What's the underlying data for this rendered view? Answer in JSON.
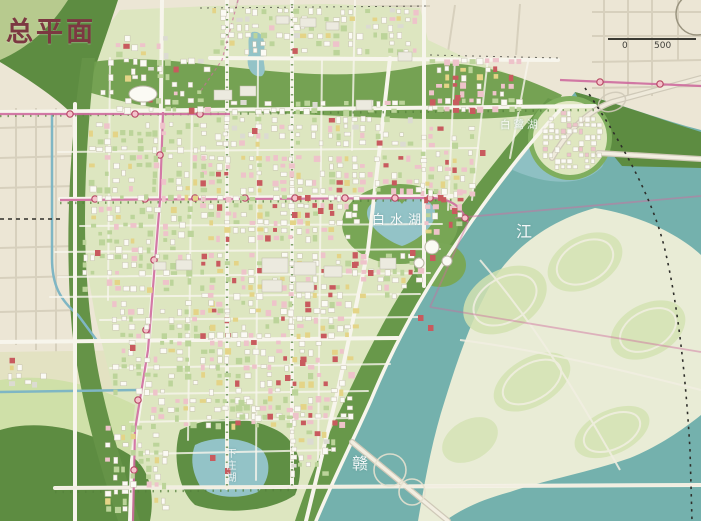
{
  "map": {
    "title": "总平面",
    "labels": {
      "lake_main": "白水湖",
      "lake_upper": "白鹭湖",
      "lake_lower": "下庄湖",
      "river_char_bottom": "赣",
      "river_char_top": "江"
    },
    "scale": {
      "zero": "0",
      "five_hundred": "500"
    },
    "palette": {
      "base": "#ece6d5",
      "baseRoad": "#d5cebb",
      "river": "#74b1ad",
      "innerLake": "#93c3c7",
      "island": "#e9ecd6",
      "islandGreen": "#d2e2b0",
      "cityBase": "#dde6c0",
      "parkGreen": "#6f9e4d",
      "forestDark": "#5d8c41",
      "hillLight": "#b7ca8e",
      "fieldGreen": "#cfe0a8",
      "roadWhite": "#f7f5ec",
      "buildingWhite": "#fbfaf4",
      "buildingStroke": "#c7c3b0",
      "buildingPink": "#eec3ca",
      "buildingRed": "#c85a5e",
      "buildingYellow": "#e4d487",
      "buildingGreen": "#bcd49a",
      "buildingGray": "#dcdbd2",
      "metro": "#cf6b9f",
      "stationFill": "#f5c2cb",
      "stationStroke": "#b84a66",
      "boundary": "#2e2e2a",
      "canal": "#7fb6c4",
      "treeLine": "#55813c",
      "titleColor": "#7c3841"
    },
    "generator": {
      "seed": 12,
      "cell": 8,
      "districts": [
        [
          212,
          8,
          205,
          42,
          0.55,
          "w"
        ],
        [
          428,
          58,
          95,
          56,
          0.6,
          "p"
        ],
        [
          100,
          58,
          105,
          52,
          0.3,
          "w"
        ],
        [
          88,
          122,
          115,
          78,
          0.55,
          "g"
        ],
        [
          215,
          100,
          200,
          48,
          0.55,
          "w"
        ],
        [
          420,
          126,
          55,
          66,
          0.6,
          "p"
        ],
        [
          200,
          155,
          158,
          88,
          0.68,
          "c"
        ],
        [
          358,
          155,
          60,
          40,
          0.55,
          "p"
        ],
        [
          82,
          206,
          112,
          88,
          0.55,
          "g"
        ],
        [
          200,
          252,
          158,
          82,
          0.6,
          "c"
        ],
        [
          360,
          252,
          60,
          48,
          0.5,
          "p"
        ],
        [
          112,
          300,
          118,
          92,
          0.55,
          "g"
        ],
        [
          235,
          340,
          118,
          84,
          0.6,
          "c"
        ],
        [
          150,
          398,
          145,
          26,
          0.55,
          "g"
        ],
        [
          105,
          425,
          62,
          85,
          0.5,
          "g"
        ],
        [
          290,
          430,
          45,
          42,
          0.5,
          "w"
        ],
        [
          424,
          180,
          34,
          52,
          0.55,
          "p"
        ],
        [
          8,
          356,
          38,
          32,
          0.5,
          "w"
        ],
        [
          115,
          35,
          70,
          40,
          0.45,
          "w"
        ]
      ],
      "village": {
        "cx": 570,
        "cy": 138,
        "r": 33,
        "density": 0.7
      },
      "bigBlocks": [
        [
          262,
          258,
          26,
          15
        ],
        [
          294,
          262,
          22,
          13
        ],
        [
          324,
          266,
          18,
          11
        ],
        [
          262,
          280,
          20,
          12
        ],
        [
          296,
          282,
          18,
          10
        ],
        [
          214,
          90,
          18,
          10
        ],
        [
          240,
          86,
          16,
          10
        ],
        [
          300,
          18,
          16,
          9
        ],
        [
          326,
          22,
          13,
          8
        ],
        [
          276,
          16,
          13,
          8
        ],
        [
          356,
          100,
          16,
          10
        ],
        [
          380,
          258,
          16,
          11
        ],
        [
          398,
          52,
          14,
          9
        ],
        [
          176,
          260,
          16,
          10
        ],
        [
          154,
          262,
          12,
          8
        ]
      ],
      "accents": [
        [
          305,
          195
        ],
        [
          318,
          208
        ],
        [
          292,
          212
        ],
        [
          455,
          95
        ],
        [
          470,
          108
        ],
        [
          438,
          195
        ],
        [
          452,
          208
        ],
        [
          300,
          360
        ],
        [
          285,
          375
        ],
        [
          252,
          128
        ],
        [
          352,
          262
        ],
        [
          368,
          270
        ],
        [
          410,
          250
        ],
        [
          430,
          255
        ],
        [
          130,
          345
        ],
        [
          95,
          250
        ],
        [
          210,
          455
        ],
        [
          225,
          468
        ],
        [
          480,
          150
        ],
        [
          418,
          315
        ],
        [
          428,
          325
        ]
      ],
      "landmarks": [
        [
          432,
          247,
          7
        ],
        [
          447,
          261,
          5
        ],
        [
          419,
          263,
          5
        ]
      ]
    }
  }
}
